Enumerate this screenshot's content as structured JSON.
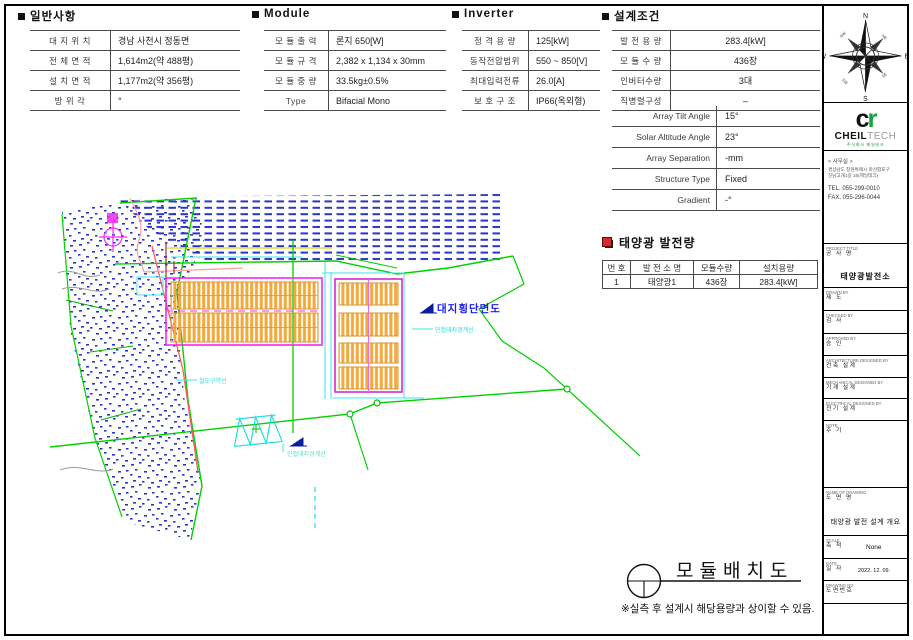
{
  "general": {
    "title": "일반사항",
    "rows": [
      {
        "label": "대 지 위 치",
        "value": "경남 사천시 정동면"
      },
      {
        "label": "전 체 면 적",
        "value": "1,614m2(약 488평)"
      },
      {
        "label": "설 치 면 적",
        "value": "1,177m2(약 356평)"
      },
      {
        "label": "방 위 각",
        "value": "°"
      }
    ]
  },
  "module": {
    "title": "Module",
    "rows": [
      {
        "label": "모 듈 출 력",
        "value": "론지 650[W]"
      },
      {
        "label": "모 듈 규 격",
        "value": "2,382 x 1,134 x 30mm"
      },
      {
        "label": "모 듈 중 량",
        "value": "33.5kg±0.5%"
      },
      {
        "label": "Type",
        "value": "Bifacial Mono"
      }
    ]
  },
  "inverter": {
    "title": "Inverter",
    "rows": [
      {
        "label": "정 격 용 량",
        "value": "125[kW]"
      },
      {
        "label": "동작전압범위",
        "value": "550 ~ 850[V]"
      },
      {
        "label": "최대입력전류",
        "value": "26.0[A]"
      },
      {
        "label": "보 호 구 조",
        "value": "IP66(옥외형)"
      }
    ]
  },
  "design": {
    "title": "설계조건",
    "rows": [
      {
        "label": "발 전 용 량",
        "value": "283.4[kW]"
      },
      {
        "label": "모 듈 수 량",
        "value": "436장"
      },
      {
        "label": "인버터수량",
        "value": "3대"
      },
      {
        "label": "직병렬구성",
        "value": "–"
      }
    ],
    "rows_en": [
      {
        "label": "Array Tilt Angle",
        "value": "15°"
      },
      {
        "label": "Solar Altitude Angle",
        "value": "23°"
      },
      {
        "label": "Array Separation",
        "value": "-mm"
      },
      {
        "label": "Structure Type",
        "value": "Fixed"
      },
      {
        "label": "Gradient",
        "value": "-°"
      }
    ]
  },
  "generation": {
    "title": "태양광 발전량",
    "headers": [
      "번 호",
      "발 전 소 명",
      "모듈수량",
      "설치용량"
    ],
    "rows": [
      [
        "1",
        "태양광1",
        "436장",
        "283.4[kW]"
      ]
    ]
  },
  "drawing": {
    "labels": {
      "site_cross_section": "대지횡단면도",
      "adjacent_boundary_upper": "인접대지경계선",
      "adjacent_boundary_lower": "인접대지경계선",
      "railway_zone": "철도구역선"
    },
    "bottom_title": "모듈배치도",
    "note": "※실측 후 설계시 해당용량과 상이할 수 있음."
  },
  "compass": {
    "n": "N",
    "e": "E",
    "s": "S",
    "w": "W",
    "ne": "NE",
    "nw": "NW",
    "se": "SE",
    "sw": "SW"
  },
  "sidebar": {
    "logo": {
      "mark_c": "c",
      "mark_r": "r",
      "name_bold": "CHEIL",
      "name_light": "TECH",
      "caption": "주식회사 제일테크"
    },
    "office": {
      "heading": "< 사무실 >",
      "address1": "경상남도 창원특례시 마산합포구",
      "address2": "진남고개1길 16(제일테크)",
      "tel": "TEL. 055-299-0010",
      "fax": "FAX. 055-296-0044"
    },
    "blocks": [
      {
        "en": "PROJECT TITLE",
        "ko": "공 사 명",
        "value": "태양광발전소"
      },
      {
        "en": "DRAWN BY",
        "ko": "제 도",
        "value": ""
      },
      {
        "en": "CHECKED BY",
        "ko": "검 사",
        "value": ""
      },
      {
        "en": "APPROVED BY",
        "ko": "승 인",
        "value": ""
      },
      {
        "en": "ARCHITECTURE DESIGNED BY",
        "ko": "건축 설계",
        "value": ""
      },
      {
        "en": "MECHANICAL DESIGNED BY",
        "ko": "기계 설계",
        "value": ""
      },
      {
        "en": "ELECTRICAL DESIGNED BY",
        "ko": "전기 설계",
        "value": ""
      },
      {
        "en": "NOTE",
        "ko": "주 기",
        "value": ""
      },
      {
        "en": "NAME OF DRAWING",
        "ko": "도 면 명",
        "value": "태양광 발전 설계 개요"
      },
      {
        "en": "SCALE",
        "ko": "축 척",
        "value": "None"
      },
      {
        "en": "DATE",
        "ko": "일 자",
        "value": "2022. 12. 09."
      },
      {
        "en": "DRAWING NO",
        "ko": "도면번호",
        "value": ""
      }
    ]
  }
}
